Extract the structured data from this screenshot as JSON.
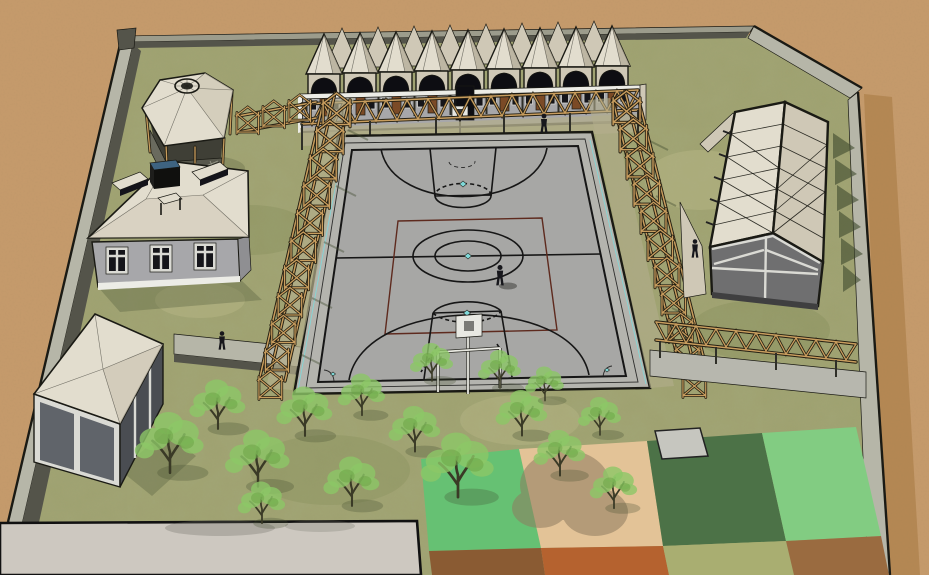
{
  "scene": {
    "type": "3d-architectural-model",
    "description": "Aerial 3D model of a walled school campus with a central basketball court, timber pergolas, gazebo and surrounding buildings",
    "buildings": [
      {
        "name": "classroom block with nine pyramidal roof units"
      },
      {
        "name": "hexagonal gazebo with ring cupola"
      },
      {
        "name": "hip-roof administration building"
      },
      {
        "name": "pyramid-roof glass pavilion"
      },
      {
        "name": "gable-roof workshop hall with exposed trusses"
      },
      {
        "name": "foreground building (flat roof only)"
      }
    ],
    "features": [
      {
        "name": "basketball court with painted markings"
      },
      {
        "name": "timber truss pergola, west side"
      },
      {
        "name": "timber truss pergola, east side"
      },
      {
        "name": "timber truss walkway, north side"
      },
      {
        "name": "timber truss bridge, south-east"
      },
      {
        "name": "perimeter boundary wall"
      },
      {
        "name": "orchard of young trees"
      },
      {
        "name": "colored ground plots, south-east corner"
      },
      {
        "name": "human scale figures"
      }
    ],
    "counts": {
      "roof_peaks": 9,
      "trees": 16,
      "people": 4,
      "ground_plots": 8
    }
  },
  "colors": {
    "sand": "#C79B6C",
    "sandShadow": "#A5793F",
    "wallTop": "#9C9C8C",
    "wallLight": "#B6B6A8",
    "wallDark": "#54544A",
    "grass": "#A0A271",
    "grassDark": "#76844E",
    "grassLight": "#C6C293",
    "courtApron": "#B4B4AE",
    "court": "#A7A7A5",
    "courtLine": "#161616",
    "courtRed": "#5E2A1E",
    "teal": "#7FD9D9",
    "roofLight": "#E2DDCE",
    "roofMid": "#CFC8B6",
    "roofShade": "#B4AC98",
    "facade": "#A7A7AA",
    "fascia": "#ECECE6",
    "arch": "#0D0D12",
    "door": "#7B4A26",
    "window": "#15151A",
    "wood": "#C89D5E",
    "woodDark": "#2A2416",
    "glass": "#60646A",
    "glassDark": "#4A4D52",
    "mullion": "#DADAD4",
    "gable": "#6F6F70",
    "path": "#B7B7AE",
    "pathWarm": "#B3AE8C",
    "foregroundRoof": "#CDC8C0",
    "treeGreen": "#8CC766",
    "treeGreenDark": "#69A144",
    "trunk": "#3A3A26",
    "shadow": "#3F4A2E",
    "patchBrightGreen": "#66C173",
    "patchTan": "#E3C397",
    "patchDarkGreen": "#4C7247",
    "patchLightGreen": "#82CC82",
    "patchBrown": "#8A5B33",
    "patchOrange": "#B5622F",
    "patchOlive": "#A9AE71",
    "patchTanBrown": "#9A6B40",
    "treeShadowOnSand": "#8F7C60",
    "boxBlue": "#3E6380",
    "boxDark": "#10100E",
    "figure": "#17171C"
  }
}
